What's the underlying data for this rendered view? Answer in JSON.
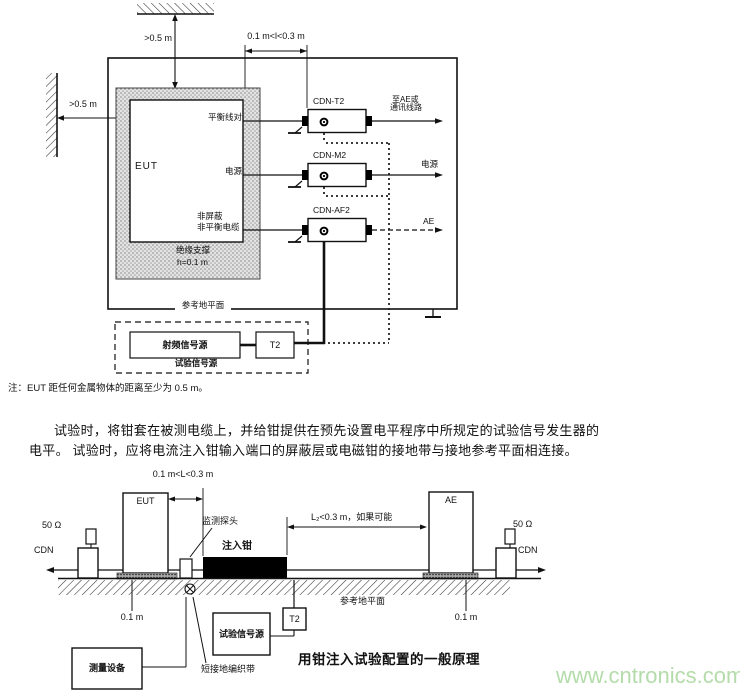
{
  "watermark": "www.cntronics.com",
  "figure1": {
    "dim_ceiling": ">0.5 m",
    "dim_wall": ">0.5 m",
    "dim_cable": "0.1 m<l<0.3 m",
    "eut_label": "EUT",
    "port_balanced": "平衡线对",
    "port_power": "电源",
    "port_unshielded_line1": "非屏蔽",
    "port_unshielded_line2": "非平衡电缆",
    "support_label": "绝缘支撑",
    "support_height": "h=0.1 m",
    "ground_plane": "参考地平面",
    "cdns": [
      {
        "name": "CDN-T2",
        "out_line1": "至AE或",
        "out_line2": "通讯线路"
      },
      {
        "name": "CDN-M2",
        "out_line1": "电源"
      },
      {
        "name": "CDN-AF2",
        "out_line1": "AE"
      }
    ],
    "rf_generator": "射频信号源",
    "transformer": "T2",
    "test_source": "试验信号源",
    "note": "注：EUT 距任何金属物体的距离至少为 0.5 m。"
  },
  "paragraph": {
    "line1": "试验时，将钳套在被测电缆上，并给钳提供在预先设置电平程序中所规定的试验信号发生器的",
    "line2": "电平。 试验时，应将电流注入钳输入端口的屏蔽层或电磁钳的接地带与接地参考平面相连接。"
  },
  "figure2": {
    "dim_cable": "0.1 m<L<0.3 m",
    "dim_clamp": "L₂<0.3 m，如果可能",
    "eut_label": "EUT",
    "ae_label": "AE",
    "r50_left": "50 Ω",
    "r50_right": "50 Ω",
    "cdn_left": "CDN",
    "cdn_right": "CDN",
    "probe_label": "监测探头",
    "clamp_label": "注入钳",
    "height_left": "0.1 m",
    "height_right": "0.1 m",
    "measuring_equipment": "测量设备",
    "test_source": "试验信号源",
    "transformer": "T2",
    "braid_label": "短接地编织带",
    "ground_plane": "参考地平面",
    "caption": "用钳注入试验配置的一般原理"
  }
}
